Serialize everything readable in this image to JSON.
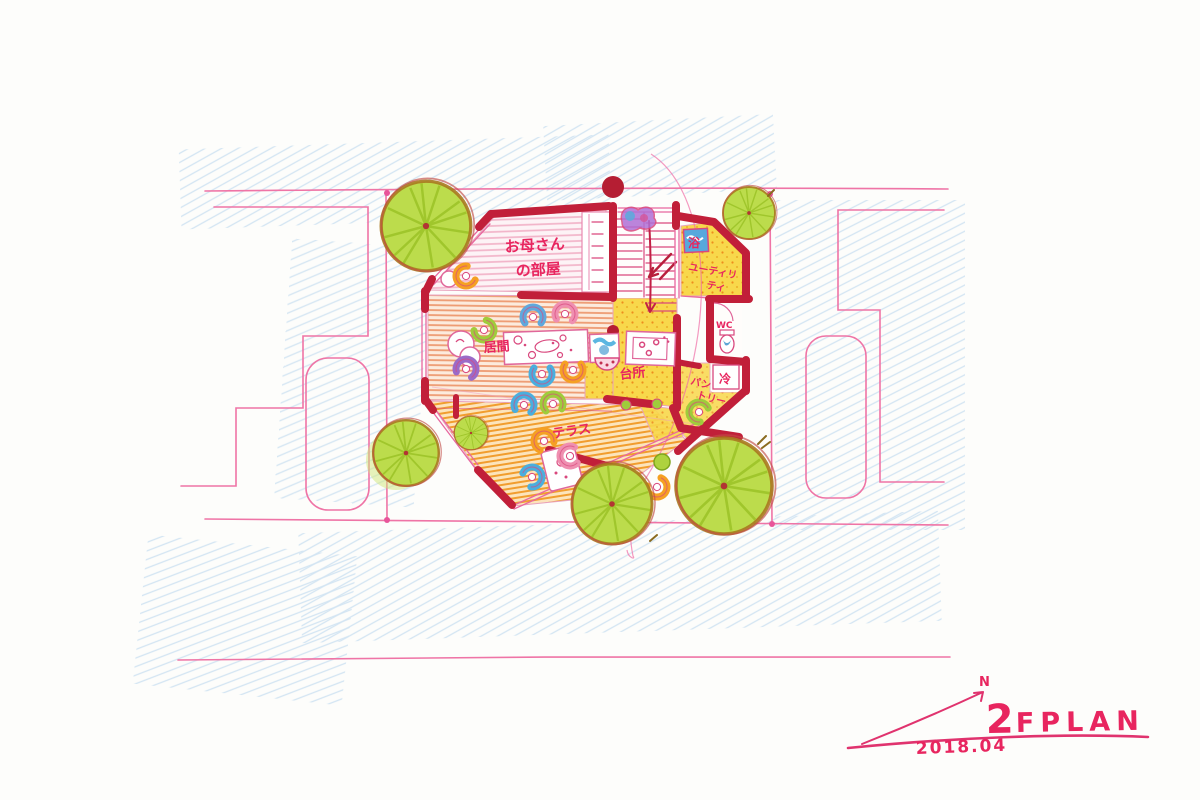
{
  "title": {
    "floor": "2",
    "plan": "FPLAN",
    "date": "2018.04",
    "north": "N"
  },
  "labels": {
    "mother1": "お母さん",
    "mother2": "の部屋",
    "living": "居間",
    "kitchen": "台所",
    "terrace": "テラス",
    "utility1": "ユーティリ",
    "utility2": "ティ",
    "pantry1": "パン",
    "pantry2": "トリー",
    "bath": "浴",
    "wc": "WC",
    "fridge": "冷"
  },
  "colors": {
    "wall": "#c11f39",
    "site_line": "#ef74a6",
    "accent_text": "#e8255f",
    "tree_fill": "#bcdc4c",
    "tree_streak": "#97bf22",
    "floor_yellow": "#f8d84b",
    "floor_living_stripe": "#ee9b72",
    "floor_terrace_stripe": "#f19d2e",
    "floor_tatami_stripe": "#f2b4c9",
    "pencil_blue": "#a9cdea",
    "chair_blue": "#4aaede",
    "chair_green": "#9fcc3b",
    "chair_orange": "#f5a023",
    "chair_purple": "#9b6bc8",
    "chair_pink": "#ef8fb0"
  }
}
